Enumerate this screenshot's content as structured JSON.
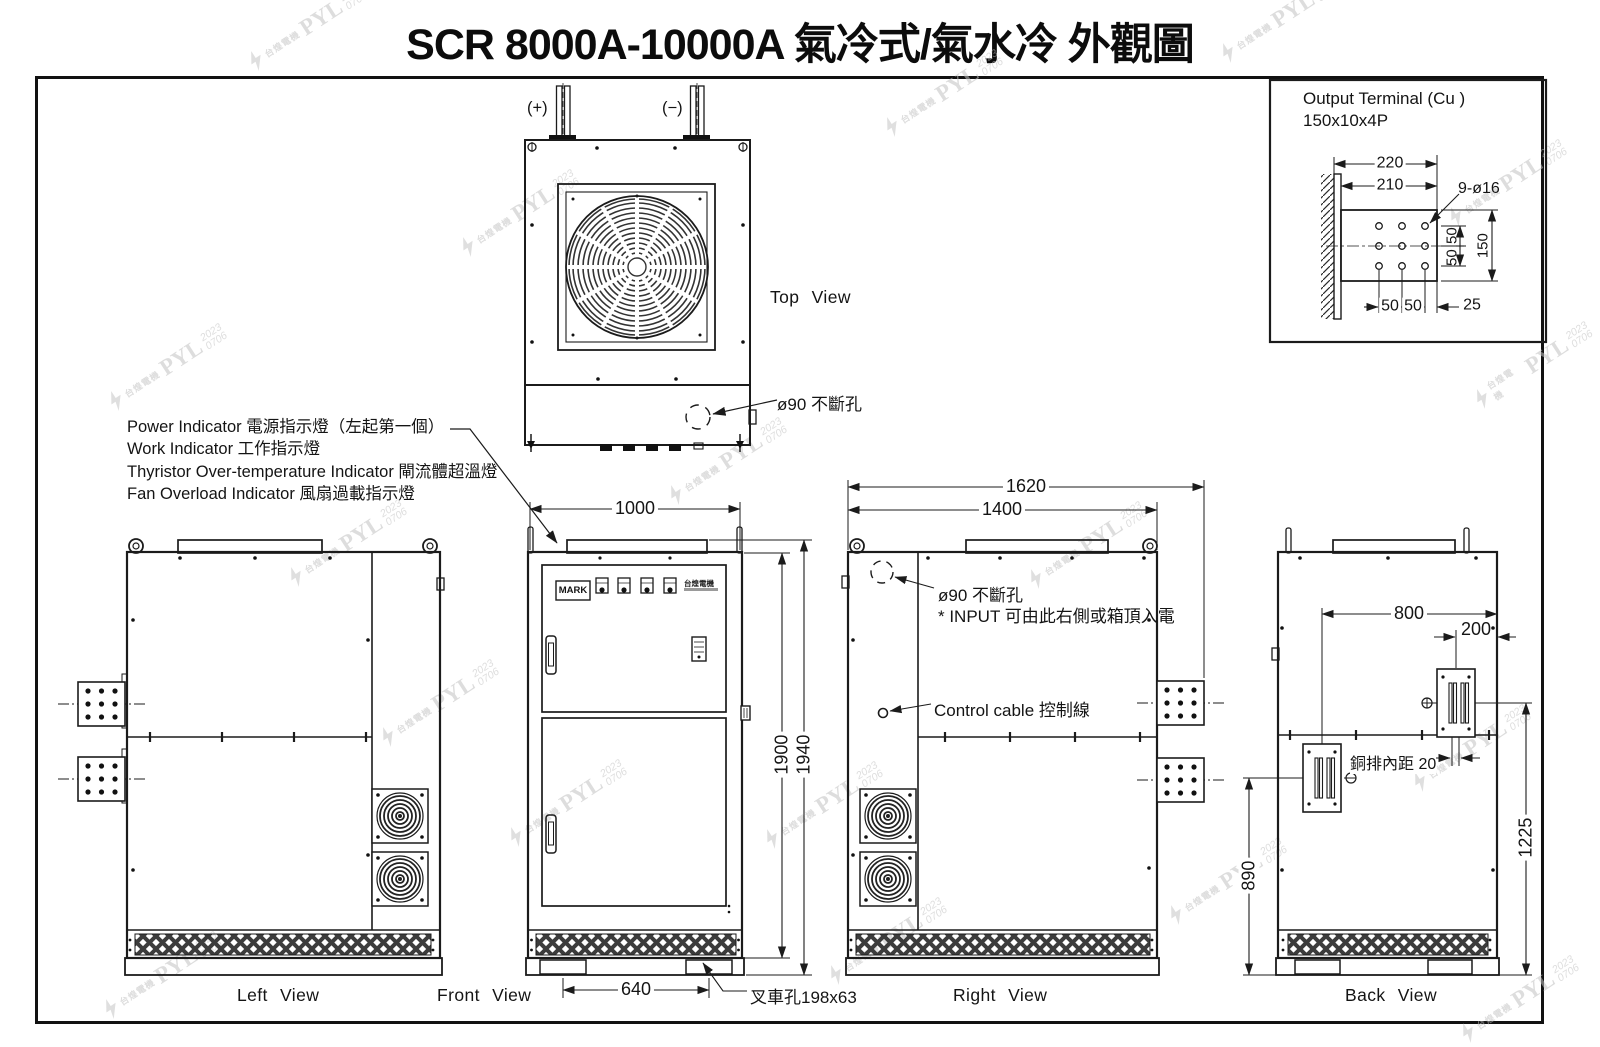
{
  "title": "SCR 8000A-10000A 氣冷式/氣水冷 外觀圖",
  "watermark": {
    "brand": "PYL",
    "year": "2023",
    "code": "0706",
    "company": "台煌電機"
  },
  "detail": {
    "line1": "Output Terminal (Cu )",
    "line2": "150x10x4P",
    "dim_220": "220",
    "dim_210": "210",
    "dim_holes": "9-ø16",
    "dim_50r1": "50",
    "dim_50r2": "50",
    "dim_150": "150",
    "dim_50b1": "50",
    "dim_50b2": "50",
    "dim_25": "25"
  },
  "legend": {
    "line1": "Power Indicator 電源指示燈（左起第一個）",
    "line2": "Work Indicator 工作指示燈",
    "line3": "Thyristor Over-temperature Indicator 閘流體超溫燈",
    "line4": "Fan Overload Indicator 風扇過載指示燈"
  },
  "top_view": {
    "caption": "Top View",
    "plus": "(+)",
    "minus": "(−)",
    "knockout": "ø90 不斷孔"
  },
  "front_view": {
    "caption": "Front View",
    "dim_width": "1000",
    "dim_h_body": "1900",
    "dim_h_total": "1940",
    "dim_fork": "640",
    "fork_label": "叉車孔198x63",
    "mark": "MARK"
  },
  "right_view": {
    "caption": "Right View",
    "dim_total": "1620",
    "dim_body": "1400",
    "knockout": "ø90 不斷孔",
    "input_note": "* INPUT 可由此右側或箱頂入電",
    "control_cable": "Control cable 控制線"
  },
  "back_view": {
    "caption": "Back View",
    "dim_800": "800",
    "dim_200": "200",
    "dim_890": "890",
    "dim_1225": "1225",
    "busbar_gap": "銅排內距 20"
  },
  "left_view": {
    "caption": "Left View"
  }
}
